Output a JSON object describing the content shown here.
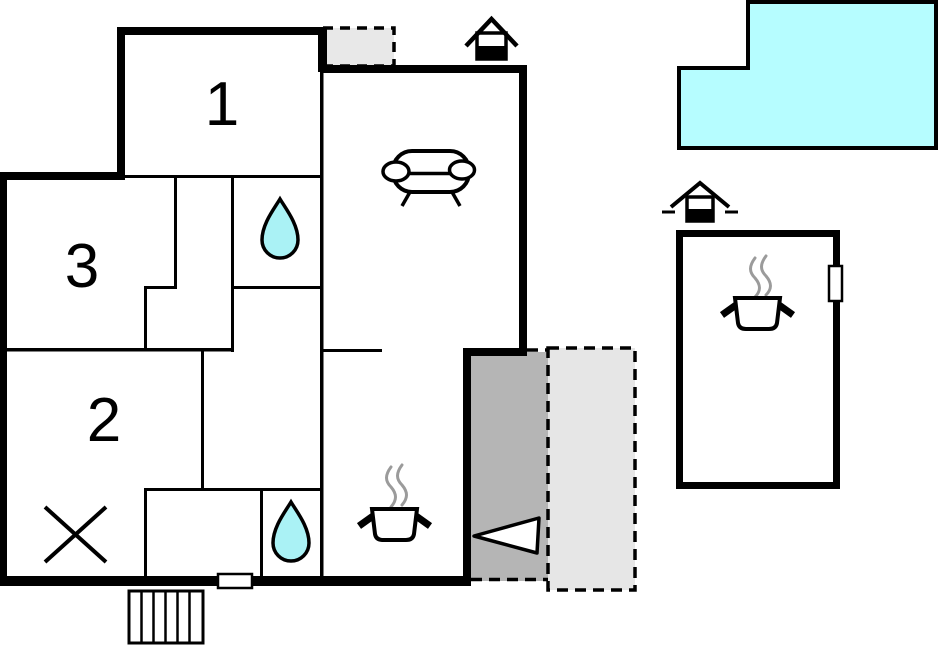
{
  "plan": {
    "type": "floor-plan",
    "background": "#FFFFFF",
    "rooms": {
      "r1": {
        "label": "1"
      },
      "r2": {
        "label": "2"
      },
      "r3": {
        "label": "3"
      }
    },
    "colors": {
      "wall": "#000000",
      "pool_fill": "#B6FDFF",
      "water_drop_fill": "#AAF2F5",
      "terrace_dark_fill": "#B5B5B5",
      "terrace_light_fill": "#E6E6E6",
      "upper_terrace_fill": "#E8E8E8",
      "steam": "#9B9B9B",
      "furniture_fill": "#FFFFFF"
    },
    "icons": [
      {
        "name": "fireplace-icon",
        "location": "main-house-roof"
      },
      {
        "name": "fireplace-icon",
        "location": "annex-roof"
      },
      {
        "name": "sofa-icon",
        "location": "living-room"
      },
      {
        "name": "cooking-pot-icon",
        "location": "kitchen"
      },
      {
        "name": "cooking-pot-icon",
        "location": "annex"
      },
      {
        "name": "water-drop-icon",
        "location": "bathroom-upper"
      },
      {
        "name": "water-drop-icon",
        "location": "bathroom-lower"
      },
      {
        "name": "entrance-arrow-icon",
        "location": "terrace"
      },
      {
        "name": "stairs-icon",
        "location": "outside-bottom"
      },
      {
        "name": "cross-icon",
        "location": "storage-room"
      },
      {
        "name": "window-marker",
        "location": "bottom-wall"
      },
      {
        "name": "door-marker",
        "location": "annex-right-wall"
      }
    ]
  }
}
